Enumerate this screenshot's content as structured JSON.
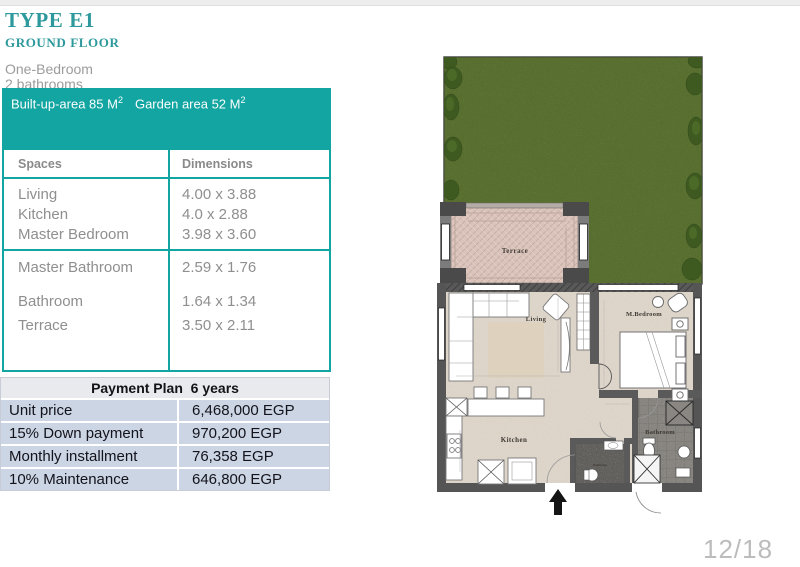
{
  "header": {
    "title": "TYPE E1",
    "subtitle": "GROUND FLOOR",
    "line1": "One-Bedroom",
    "line2": "2 bathrooms"
  },
  "banner": {
    "built_label": "Built-up-area 85 M",
    "built_sup": "2",
    "garden_label": "Garden area 52 M",
    "garden_sup": "2"
  },
  "spaces_table": {
    "headers": [
      "Spaces",
      "Dimensions"
    ],
    "group1": [
      {
        "space": "Living",
        "dim": "4.00 x 3.88"
      },
      {
        "space": "Kitchen",
        "dim": "4.0 x 2.88"
      },
      {
        "space": "Master Bedroom",
        "dim": "3.98 x 3.60"
      }
    ],
    "group2": [
      {
        "space": "Master Bathroom",
        "dim": "2.59 x 1.76"
      },
      {
        "space": "Bathroom",
        "dim": "1.64 x 1.34"
      },
      {
        "space": "Terrace",
        "dim": "3.50 x 2.11"
      }
    ]
  },
  "payment_table": {
    "title": "Payment Plan  6 years",
    "rows": [
      {
        "label": "Unit price",
        "value": "6,468,000 EGP"
      },
      {
        "label": "15% Down payment",
        "value": "970,200 EGP"
      },
      {
        "label": "Monthly  installment",
        "value": "76,358 EGP"
      },
      {
        "label": "10% Maintenance",
        "value": "646,800 EGP"
      }
    ]
  },
  "floorplan": {
    "labels": {
      "terrace": "Terrace",
      "living": "Living",
      "bedroom": "M.Bedroom",
      "kitchen": "Kitchen",
      "bathroom": "Bathroom",
      "bathroom_small": "Bathroom"
    }
  },
  "footer": {
    "page": "12/18"
  },
  "colors": {
    "teal": "#12a5a1",
    "title_teal": "#2d999c",
    "payment_row_bg": "#ccd5e3",
    "payment_head_bg": "#e9eaee",
    "garden_green": "#6f8f3e"
  }
}
